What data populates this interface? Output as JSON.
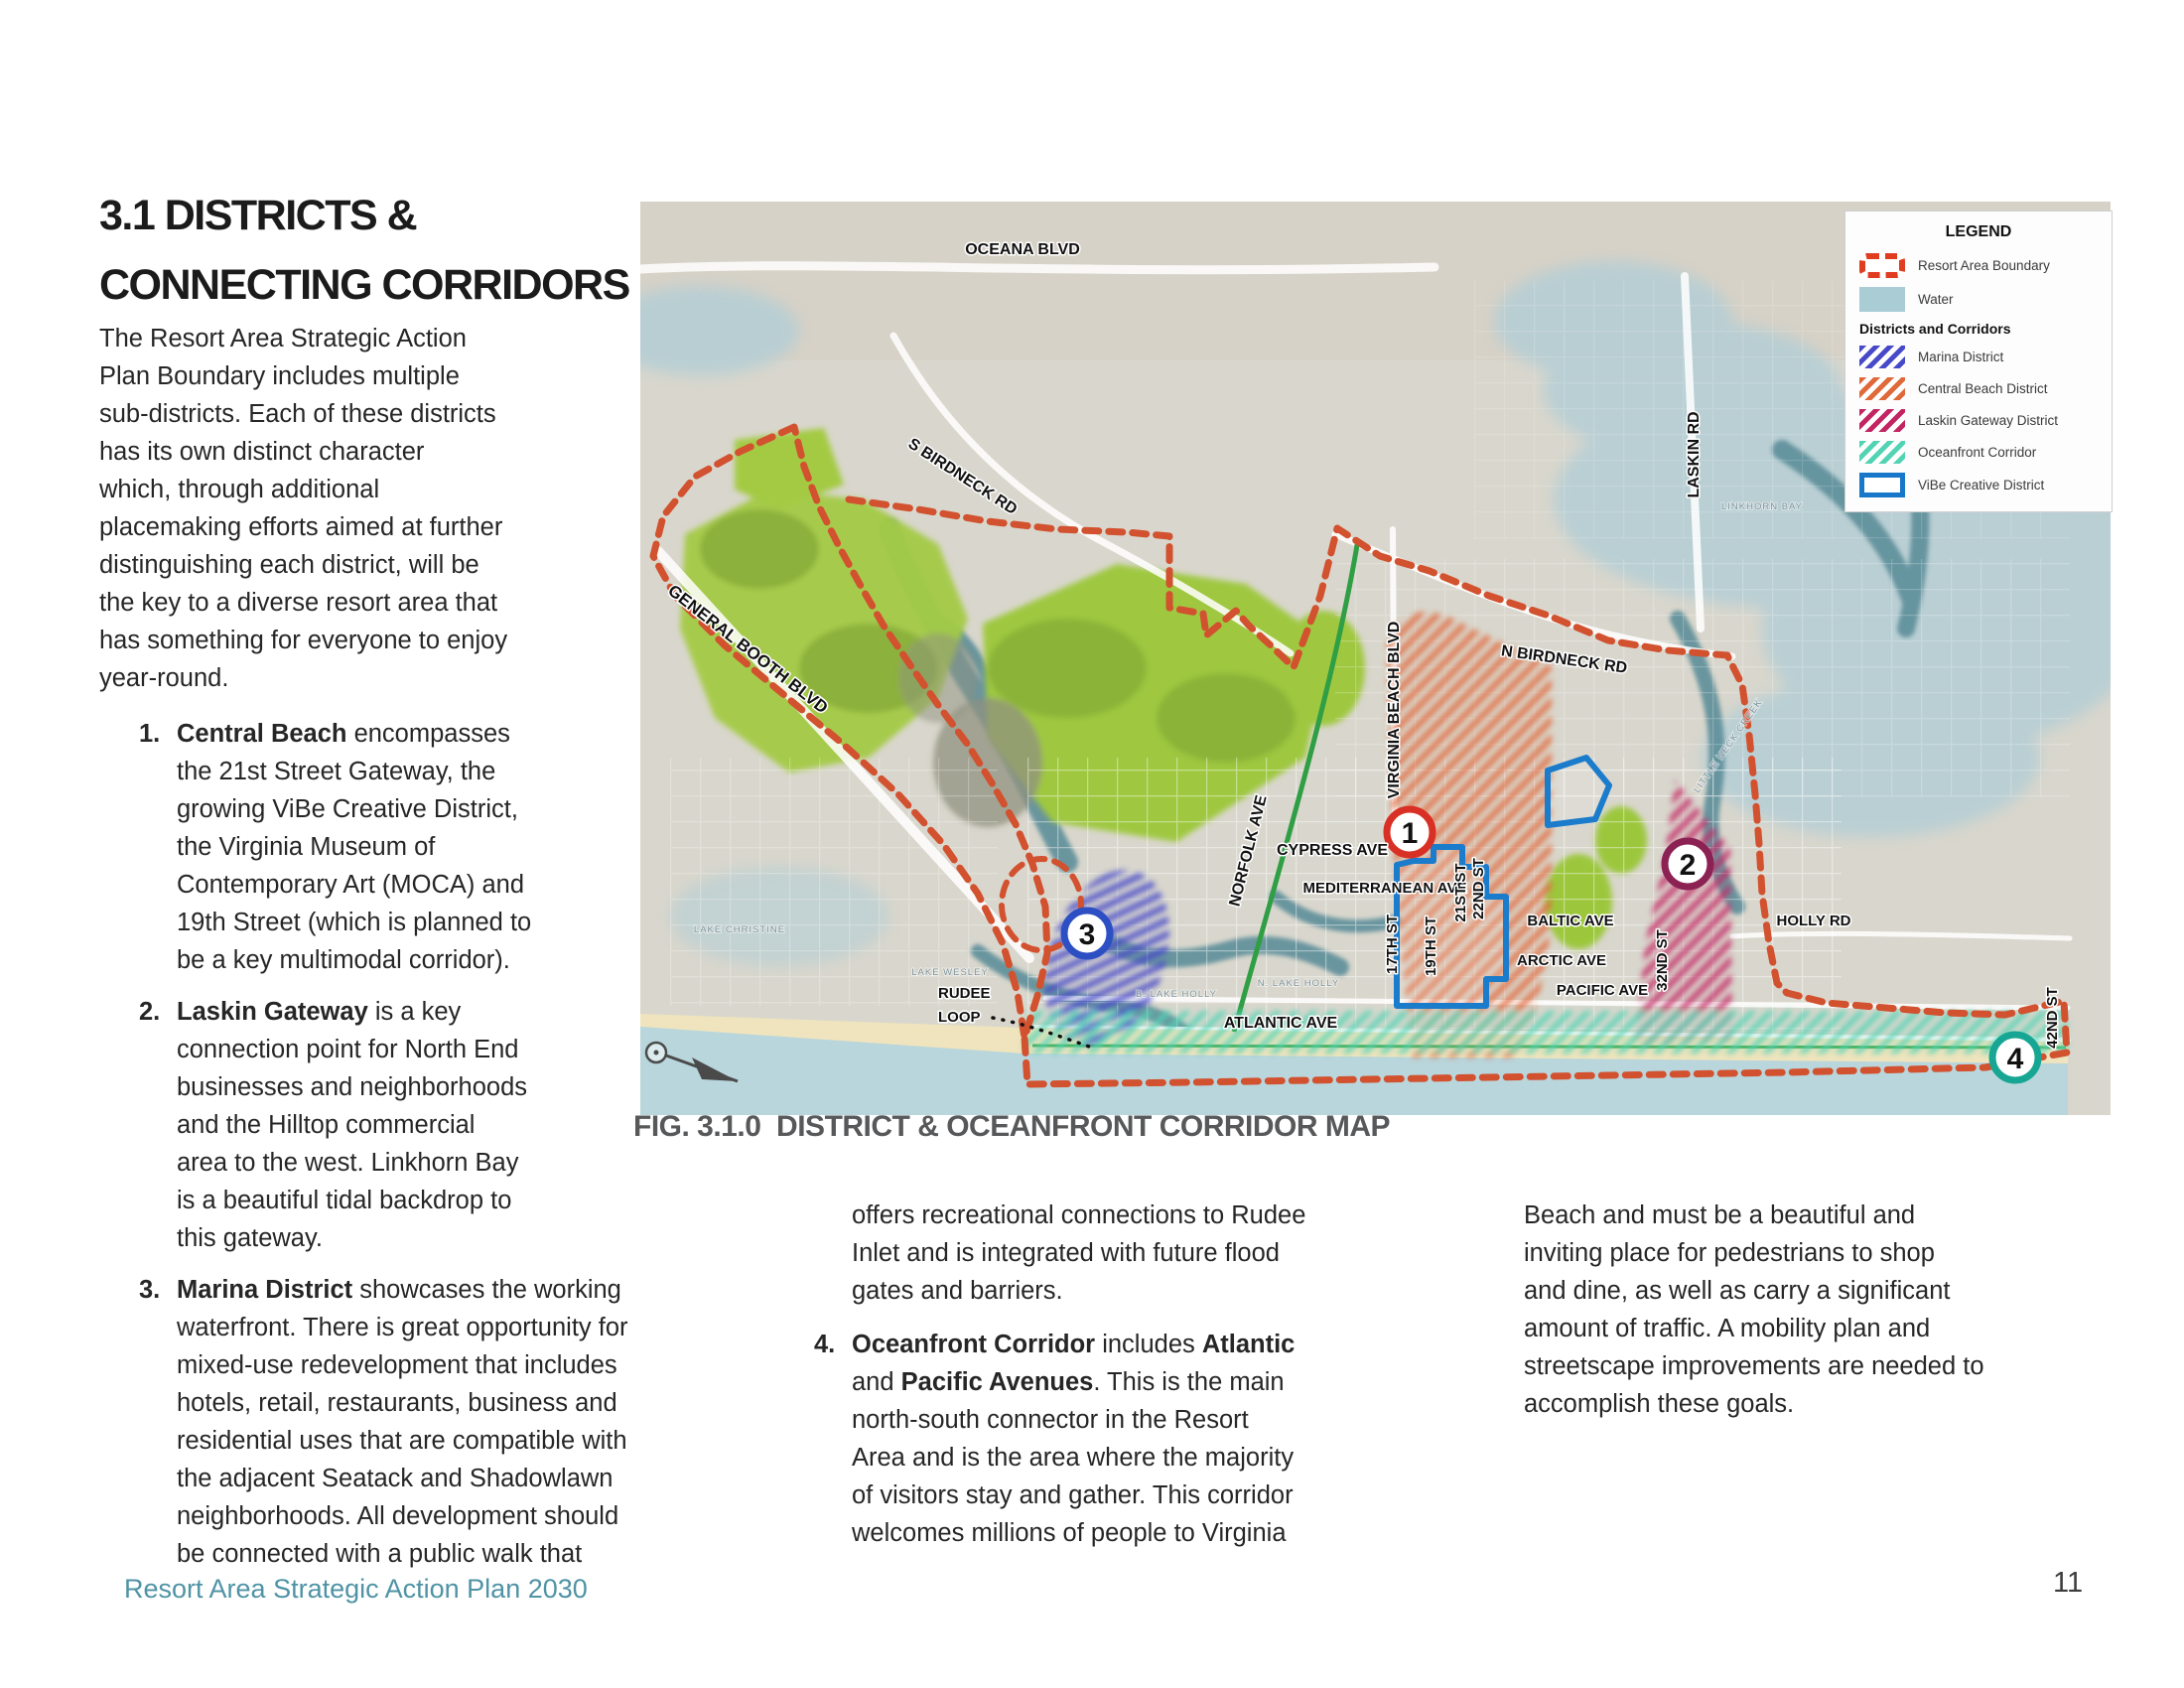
{
  "page": {
    "section_title": "3.1 DISTRICTS &\nCONNECTING CORRIDORS",
    "footer": "Resort Area Strategic Action Plan 2030",
    "page_number": "11"
  },
  "left_column": {
    "intro": "The Resort Area Strategic Action\nPlan Boundary includes multiple\nsub-districts. Each of these districts\nhas its own distinct character\nwhich, through additional\nplacemaking efforts aimed at further\ndistinguishing each district, will be\nthe key to a diverse resort area that\nhas something for everyone to enjoy\nyear-round.",
    "items": [
      {
        "num": "1.",
        "bold": "Central Beach",
        "rest": " encompasses\nthe 21st Street Gateway, the\ngrowing ViBe Creative District,\nthe Virginia Museum of\nContemporary Art (MOCA) and\n19th Street (which is planned to\nbe a key multimodal corridor)."
      },
      {
        "num": "2.",
        "bold": "Laskin Gateway",
        "rest": " is a key\nconnection point for North End\nbusinesses and neighborhoods\nand the Hilltop commercial\narea to the west. Linkhorn Bay\nis a beautiful tidal backdrop to\nthis gateway."
      },
      {
        "num": "3.",
        "bold": "Marina District",
        "rest": " showcases the working\nwaterfront. There is great opportunity for\nmixed-use redevelopment that includes\nhotels, retail, restaurants, business and\nresidential uses that are compatible with\nthe adjacent Seatack and Shadowlawn\nneighborhoods. All development should\nbe connected with a public walk that"
      }
    ]
  },
  "middle_column": {
    "continuation": "offers recreational connections to Rudee\nInlet and is integrated with future flood\ngates and barriers.",
    "item4": {
      "num": "4.",
      "bold1": "Oceanfront Corridor",
      "text1": " includes ",
      "bold2": "Atlantic",
      "text2": "\nand ",
      "bold3": "Pacific Avenues",
      "rest": ". This is the main\nnorth-south connector in the Resort\nArea and is the area where the majority\nof visitors stay and gather. This corridor\nwelcomes millions of people to Virginia"
    }
  },
  "right_column": {
    "continuation": "Beach and must be a beautiful and\ninviting place for pedestrians to shop\nand dine, as well as carry a significant\namount of traffic. A mobility plan and\nstreetscape improvements are needed to\naccomplish these goals."
  },
  "figure": {
    "caption": "FIG. 3.1.0  DISTRICT & OCEANFRONT CORRIDOR MAP"
  },
  "legend": {
    "title": "LEGEND",
    "boundary_label": "Resort Area Boundary",
    "water_label": "Water",
    "subheading": "Districts and Corridors",
    "items": [
      {
        "label": "Marina District",
        "color": "#4749c9"
      },
      {
        "label": "Central Beach District",
        "color": "#e0693a"
      },
      {
        "label": "Laskin Gateway District",
        "color": "#c32563"
      },
      {
        "label": "Oceanfront Corridor",
        "color": "#52d4b4"
      },
      {
        "label": "ViBe Creative District",
        "color": "#1877c9"
      }
    ]
  },
  "map": {
    "labels": {
      "oceana": "OCEANA BLVD",
      "s_birdneck": "S BIRDNECK RD",
      "general_booth": "GENERAL BOOTH BLVD",
      "norfolk": "NORFOLK AVE",
      "cypress": "CYPRESS AVE",
      "mediterranean": "MEDITERRANEAN AVE",
      "virginia_beach": "VIRGINIA BEACH BLVD",
      "n_birdneck": "N BIRDNECK RD",
      "laskin": "LASKIN RD",
      "st17": "17TH ST",
      "st19": "19TH ST",
      "st21": "21ST ST",
      "st22": "22ND ST",
      "baltic": "BALTIC AVE",
      "arctic": "ARCTIC AVE",
      "pacific": "PACIFIC AVE",
      "st32": "32ND ST",
      "holly": "HOLLY RD",
      "st42": "42ND ST",
      "atlantic": "ATLANTIC AVE",
      "rudee_line1": "RUDEE",
      "rudee_line2": "LOOP",
      "lake_christine": "LAKE CHRISTINE",
      "lake_wesley": "LAKE WESLEY",
      "b_lake_holly": "B. LAKE HOLLY",
      "n_lake_holly": "N. LAKE HOLLY",
      "linkhorn_bay": "LINKHORN BAY",
      "little_neck_creek": "LITTLE NECK CREEK"
    },
    "markers": [
      {
        "n": "1",
        "color": "#d93025"
      },
      {
        "n": "2",
        "color": "#8c2153"
      },
      {
        "n": "3",
        "color": "#2c4fc4"
      },
      {
        "n": "4",
        "color": "#17a693"
      }
    ]
  },
  "colors": {
    "boundary_red": "#d2512f",
    "water": "#a9ccd5",
    "marina": "#4749c9",
    "central_beach": "#e0693a",
    "laskin_gateway": "#c32563",
    "oceanfront": "#52d4b4",
    "vibe_blue": "#1877c9",
    "footer_teal": "#4f93a5"
  }
}
